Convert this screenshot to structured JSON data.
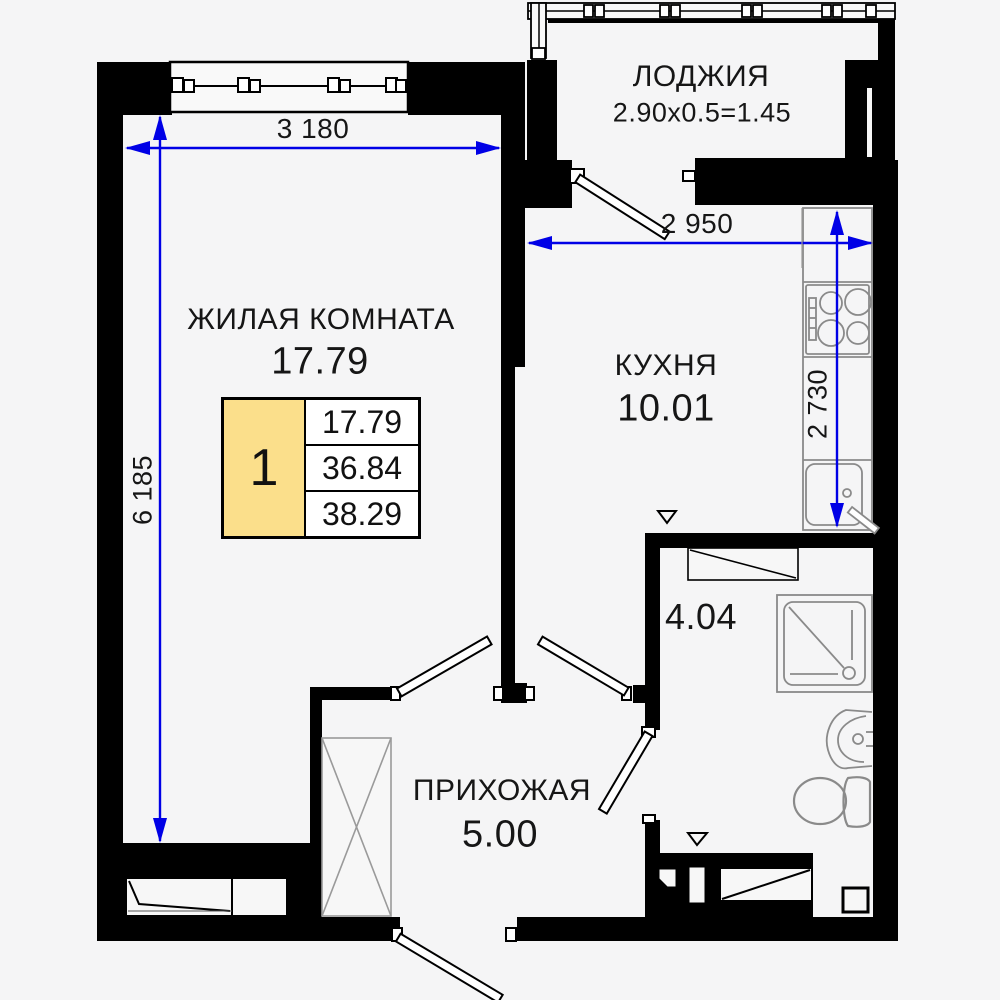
{
  "plan_title": "apartment-floor-plan",
  "rooms": {
    "loggia": {
      "label": "ЛОДЖИЯ",
      "area": "2.90x0.5=1.45"
    },
    "living": {
      "label": "ЖИЛАЯ КОМНАТА",
      "area": "17.79"
    },
    "kitchen": {
      "label": "КУХНЯ",
      "area": "10.01"
    },
    "hallway": {
      "label": "ПРИХОЖАЯ",
      "area": "5.00"
    },
    "bathroom": {
      "area": "4.04"
    }
  },
  "dimensions": {
    "living_width": "3 180",
    "living_height": "6 185",
    "kitchen_width": "2 950",
    "kitchen_depth": "2 730"
  },
  "unit_card": {
    "rooms_count": "1",
    "row1": "17.79",
    "row2": "36.84",
    "row3": "38.29"
  },
  "colors": {
    "dimension_blue": "#0000e6",
    "card_yellow": "#fbdf8b",
    "wall_black": "#000000",
    "furniture_gray": "#8a8a8a"
  }
}
